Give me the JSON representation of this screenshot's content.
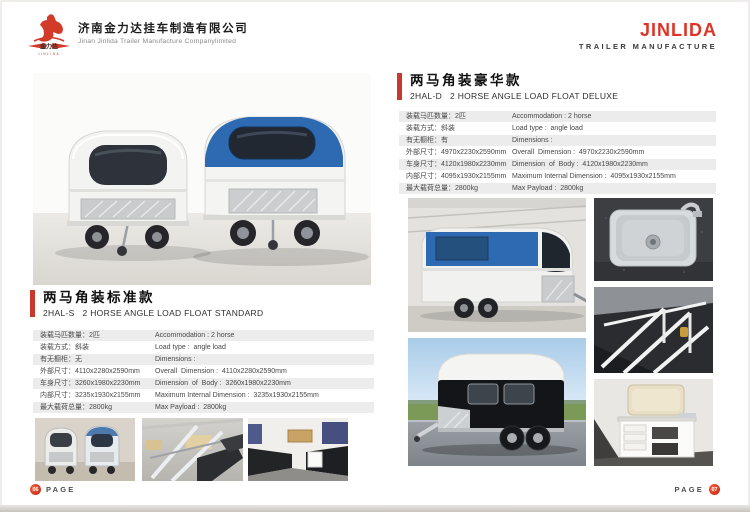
{
  "colors": {
    "accent_red": "#c8382b",
    "brand_red": "#de3427",
    "table_stripe": "#ececec",
    "trailer_blue": "#2e6ab2"
  },
  "header": {
    "company_name_cn": "济南金力达挂车制造有限公司",
    "company_name_en": "Jinan Jinlida Trailer Manufacture Companylimited",
    "logo_text": "金力达",
    "brand": "JINLIDA",
    "brand_subtitle": "TRAILER MANUFACTURE"
  },
  "left_section": {
    "title_cn": "两马角装标准款",
    "subtitle_en": "2HAL-S   2 HORSE ANGLE LOAD FLOAT STANDARD",
    "specs": [
      {
        "cn": "装载马匹数量：2匹",
        "en": "Accommodation : 2 horse"
      },
      {
        "cn": "装载方式：斜装",
        "en": "Load type :  angle load"
      },
      {
        "cn": "有无橱柜：无",
        "en": "Dimensions :"
      },
      {
        "cn": "外部尺寸：4110x2280x2590mm",
        "en": "Overall  Dimension :  4110x2280x2590mm"
      },
      {
        "cn": "车身尺寸：3260x1980x2230mm",
        "en": "Dimension  of  Body :  3260x1980x2230mm"
      },
      {
        "cn": "内部尺寸：3235x1930x2155mm",
        "en": "Maximum Internal Dimension :  3235x1930x2155mm"
      },
      {
        "cn": "最大载荷总量：2800kg",
        "en": "Max Payload :  2800kg"
      }
    ]
  },
  "right_section": {
    "title_cn": "两马角装豪华款",
    "subtitle_en": "2HAL-D   2 HORSE ANGLE LOAD FLOAT DELUXE",
    "specs": [
      {
        "cn": "装载马匹数量：2匹",
        "en": "Accommodation : 2 horse"
      },
      {
        "cn": "装载方式：斜装",
        "en": "Load type :  angle load"
      },
      {
        "cn": "有无橱柜：有",
        "en": "Dimensions :"
      },
      {
        "cn": "外部尺寸：4970x2230x2590mm",
        "en": "Overall  Dimension :  4970x2230x2590mm"
      },
      {
        "cn": "车身尺寸：4120x1980x2230mm",
        "en": "Dimension  of  Body :  4120x1980x2230mm"
      },
      {
        "cn": "内部尺寸：4095x1930x2155mm",
        "en": "Maximum Internal Dimension :  4095x1930x2155mm"
      },
      {
        "cn": "最大载荷总量：2800kg",
        "en": "Max Payload :  2800kg"
      }
    ]
  },
  "footer": {
    "page_label": "PAGE",
    "left_page_number": "06",
    "right_page_number": "07"
  }
}
